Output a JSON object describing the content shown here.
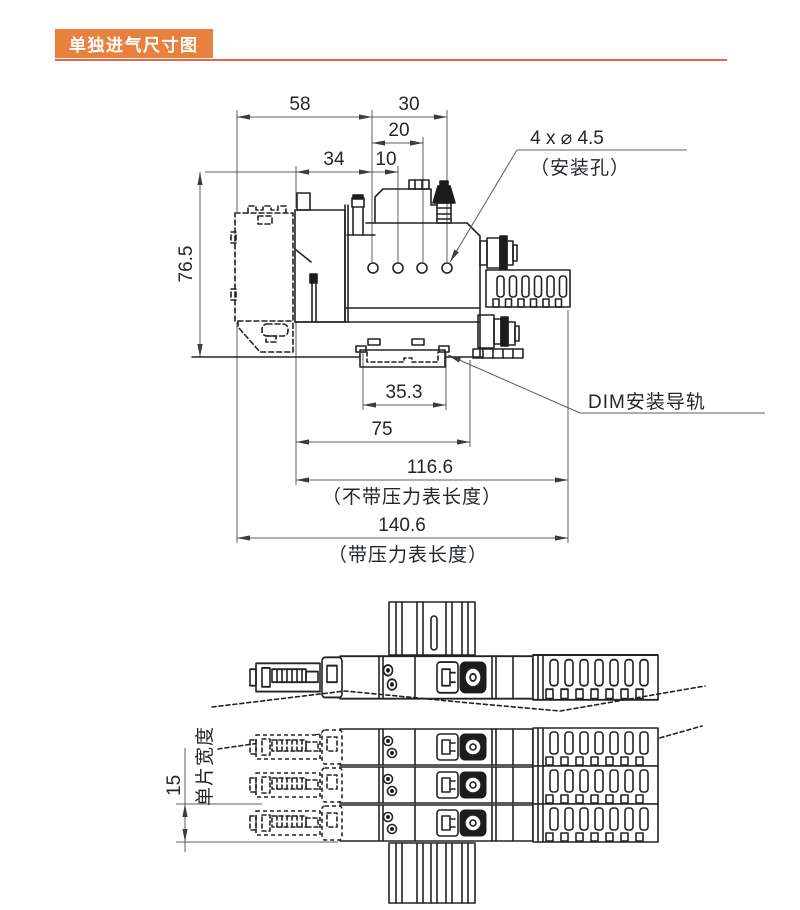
{
  "accent_color": "#E8813E",
  "rule_color": "#F0653E",
  "header": {
    "title": "单独进气尺寸图"
  },
  "side_view": {
    "dims": {
      "d58": "58",
      "d30": "30",
      "d20": "20",
      "d34": "34",
      "d10": "10",
      "d76_5": "76.5",
      "d35_3": "35.3",
      "d75": "75",
      "d116_6": "116.6",
      "d140_6": "140.6"
    },
    "labels": {
      "mounting_hole_callout": "4 x ⌀ 4.5",
      "mounting_hole_note": "（安装孔）",
      "din_rail": "DIM安装导轨",
      "len_without_gauge": "（不带压力表长度）",
      "len_with_gauge": "（带压力表长度）"
    }
  },
  "top_view": {
    "dims": {
      "d15": "15"
    },
    "labels": {
      "slice_width": "单片宽度"
    }
  }
}
